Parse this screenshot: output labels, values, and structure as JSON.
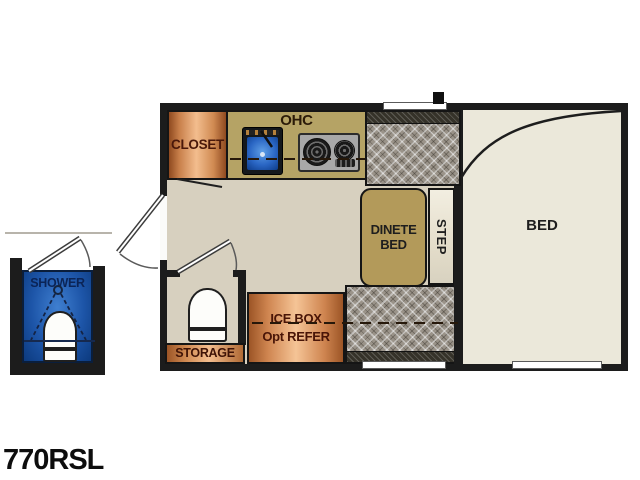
{
  "model": "770RSL",
  "floorplan": {
    "closet": {
      "label": "CLOSET"
    },
    "kitchen": {
      "ohc": "OHC"
    },
    "dinette": {
      "line1": "DINETE",
      "line2": "BED"
    },
    "step": {
      "label": "STEP"
    },
    "bed": {
      "label": "BED"
    },
    "icebox": {
      "line1": "ICE BOX",
      "line2": "Opt REFER"
    },
    "storage": {
      "label": "STORAGE"
    },
    "shower": {
      "label": "SHOWER"
    },
    "colors": {
      "wall": "#1c1c1c",
      "floor": "#d7d0bf",
      "bed_cream": "#ebe8da",
      "counter_tan": "#b5a365",
      "table_tan": "#b39a5a",
      "copper_light": "#f3bd8e",
      "copper_dark": "#8f4a20",
      "cushion_gray": "#9a9389",
      "shower_blue": "#1d55a8",
      "sink_blue": "#2a66c4",
      "copper_label_brown": "#4a180a",
      "shower_label_navy": "#0b2456"
    }
  }
}
